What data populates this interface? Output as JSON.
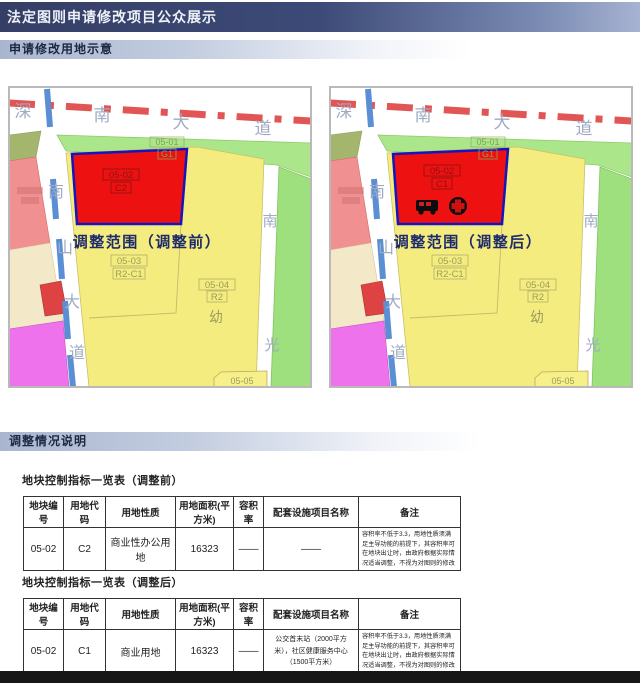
{
  "page": {
    "title": "法定图则申请修改项目公众展示",
    "section1": "申请修改用地示意",
    "section2": "调整情况说明"
  },
  "maps": {
    "shared": {
      "road_top": [
        "深",
        "南",
        "大",
        "道"
      ],
      "road_left": [
        "南",
        "山",
        "大",
        "道"
      ],
      "road_right": [
        "南",
        "光"
      ],
      "labels": {
        "g1_line1": "05-01",
        "g1_line2": "G1",
        "p03_line1": "05-03",
        "p03_line2": "R2-C1",
        "p04_line1": "05-04",
        "p04_line2": "R2",
        "kindergarten": "幼",
        "p05": "05-05"
      }
    },
    "before": {
      "caption": "调整范围（调整前）",
      "parcel_line1": "05-02",
      "parcel_line2": "C2"
    },
    "after": {
      "caption": "调整范围（调整后）",
      "parcel_line1": "05-02",
      "parcel_line2": "C1",
      "icons": [
        "bus-icon",
        "health-cross-icon"
      ]
    },
    "colors": {
      "parcel_red": "#ee1111",
      "parcel_red_border": "#1515c0",
      "parcel_yellow": "#f4ec7e",
      "parcel_green": "#abe68b",
      "parcel_salmon": "#f09090",
      "parcel_magenta": "#ee72ec",
      "parcel_cream": "#f3e9c8",
      "road_dash_red": "#e25555",
      "road_dash_blue": "#5b8fd4"
    }
  },
  "tables": {
    "before": {
      "title": "地块控制指标一览表（调整前）",
      "headers": [
        "地块编号",
        "用地代码",
        "用地性质",
        "用地面积(平方米)",
        "容积率",
        "配套设施项目名称",
        "备注"
      ],
      "rows": [
        [
          "05-02",
          "C2",
          "商业性办公用地",
          "16323",
          "——",
          "——",
          "容积率不低于3.3，用地性质须满足主导功能的前提下，其容积率可在地块出让时，由政府根据实际情况适当调整，不视为对图则的修改"
        ]
      ]
    },
    "after": {
      "title": "地块控制指标一览表（调整后）",
      "headers": [
        "地块编号",
        "用地代码",
        "用地性质",
        "用地面积(平方米)",
        "容积率",
        "配套设施项目名称",
        "备注"
      ],
      "rows": [
        [
          "05-02",
          "C1",
          "商业用地",
          "16323",
          "——",
          "公交首末站（2000平方米），社区健康服务中心（1500平方米）",
          "容积率不低于3.3，用地性质须满足主导功能的前提下，其容积率可在地块出让时，由政府根据实际情况适当调整，不视为对图则的修改"
        ]
      ]
    }
  }
}
